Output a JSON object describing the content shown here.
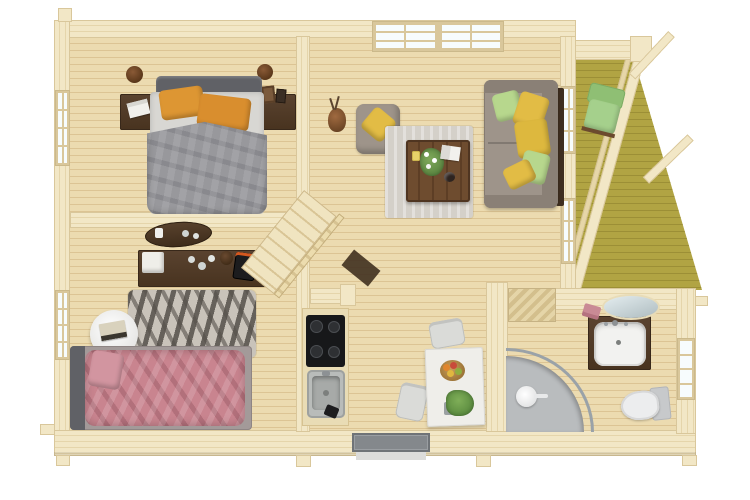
{
  "scene": {
    "type": "3d-floor-plan-top-down-render",
    "setting": "wooden-log-cabin-interior",
    "background": "#ffffff"
  },
  "colors": {
    "bg": "#ffffff",
    "wall": "#f2e7c6",
    "wallLine": "#e5d5ab",
    "wallEdge": "#d9c79b",
    "floor": "#ecdbb0",
    "floorLine": "#dcc494",
    "deck": "#b1a443",
    "deckLine": "#9c8f36",
    "darkWood": "#4e3a27",
    "tableWood": "#6e4c2f",
    "sofa": "#9e948a",
    "sofaDark": "#8a8076",
    "pillowYellow": "#e2bc45",
    "pillowGreen": "#b7d78d",
    "pillowOrange": "#dd9633",
    "bedGray": "#98989c",
    "bedSheet": "#d8d7d3",
    "headboard": "#606166",
    "pinkBed": "#c9848f",
    "rugGray": "#d4d0c9",
    "zebraBase": "#c9c3ba",
    "zebraStripe": "#55504a",
    "chrome": "#9aa2a8",
    "showerBase": "#b9bcbe",
    "toiletTank": "#c7c9cb",
    "porchChairGreen": "#a5d08c",
    "windowPane": "#f7fcfd",
    "doorGray": "#84888c",
    "mirror": "#c4d1d5",
    "cooktopBlack": "#17181a",
    "sinkSteel": "#b9bcba",
    "towelPink": "#c98a95"
  },
  "rooms": {
    "master_bedroom": {
      "position": "top-left",
      "items": [
        "double-bed-gray-duvet",
        "orange-pillow-left",
        "orange-pillow-right",
        "gray-headboard",
        "nightstand-left",
        "nightstand-right",
        "magazine-on-nightstand",
        "picture-frames",
        "wall-sconce-left",
        "wall-sconce-right",
        "window-left-wall"
      ]
    },
    "second_bedroom": {
      "position": "bottom-left",
      "items": [
        "double-bed-pink-duvet",
        "gray-bed-frame",
        "zebra-rug",
        "round-side-table",
        "books-on-table",
        "sideboard-dark-wood",
        "white-storage-box",
        "glassware-set",
        "coffee-machine",
        "oval-wall-shelf",
        "candles",
        "window-left-wall"
      ]
    },
    "living_room": {
      "position": "top-center",
      "items": [
        "large-double-window-top-wall",
        "sofa-gray",
        "green-pillows",
        "yellow-pillows",
        "ottoman-armchair",
        "yellow-pillow-on-ottoman",
        "gray-rug",
        "wood-coffee-table",
        "flower-vase-on-table",
        "open-book-on-table",
        "coffee-cup",
        "drink-glass",
        "floor-vase-with-branches",
        "staircase-with-railing",
        "window-east-wall-upper",
        "window-east-wall-lower"
      ]
    },
    "kitchen_nook": {
      "position": "bottom-center-left",
      "items": [
        "kitchen-counter",
        "induction-cooktop-4-burners",
        "steel-sink",
        "faucet",
        "dark-utensil"
      ]
    },
    "dining_area": {
      "position": "bottom-center",
      "items": [
        "white-dining-table",
        "fruit-bowl",
        "potted-plant",
        "dining-chair-top",
        "dining-chair-left"
      ]
    },
    "bathroom": {
      "position": "bottom-right",
      "items": [
        "quarter-circle-shower",
        "shower-column",
        "vanity-sink-dark-cabinet",
        "oval-mirror",
        "pink-towels",
        "toilet-with-tank",
        "window-right-wall",
        "open-door-leaf"
      ]
    },
    "porch_deck": {
      "position": "right",
      "items": [
        "olive-deck-boards",
        "green-lounge-chair",
        "railing-slanted",
        "pergola-corner-post",
        "pergola-beam-upper",
        "pergola-beam-lower",
        "header-beam"
      ]
    },
    "structure": {
      "items": [
        "log-walls",
        "entrance-door-bottom-wall",
        "door-threshold",
        "log-end-tabs"
      ]
    }
  }
}
